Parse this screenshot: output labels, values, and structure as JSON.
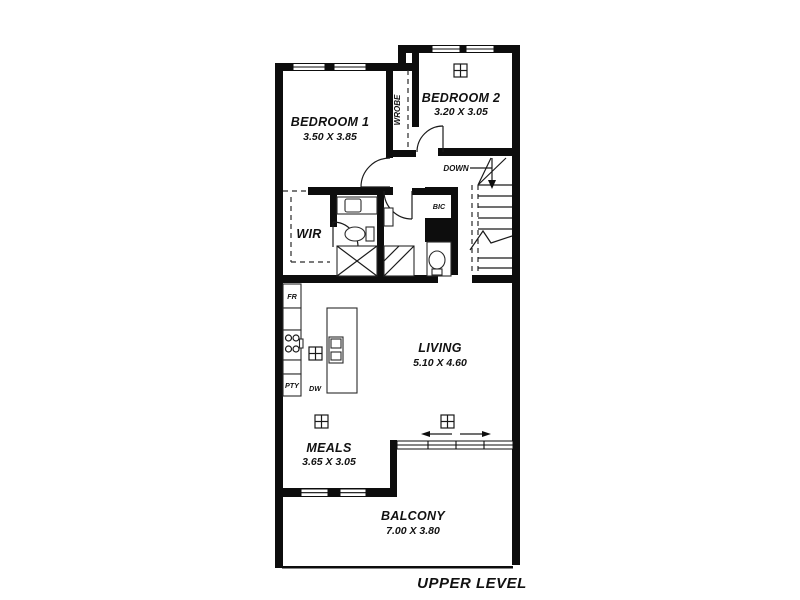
{
  "plan": {
    "level_label": "UPPER LEVEL",
    "rooms": {
      "bedroom1": {
        "name": "BEDROOM 1",
        "dims": "3.50 X 3.85"
      },
      "bedroom2": {
        "name": "BEDROOM 2",
        "dims": "3.20 X 3.05"
      },
      "living": {
        "name": "LIVING",
        "dims": "5.10 X 4.60"
      },
      "meals": {
        "name": "MEALS",
        "dims": "3.65 X 3.05"
      },
      "balcony": {
        "name": "BALCONY",
        "dims": "7.00 X 3.80"
      },
      "wir": {
        "name": "WIR"
      }
    },
    "annotations": {
      "wardrobe": "WROBE",
      "stairs_direction": "DOWN",
      "built_in_cupboard": "BIC",
      "fridge": "FR",
      "pantry": "PTY",
      "dishwasher": "DW"
    },
    "colors": {
      "wall": "#0d0d0d",
      "line": "#2a2a2a",
      "background": "#ffffff"
    }
  }
}
